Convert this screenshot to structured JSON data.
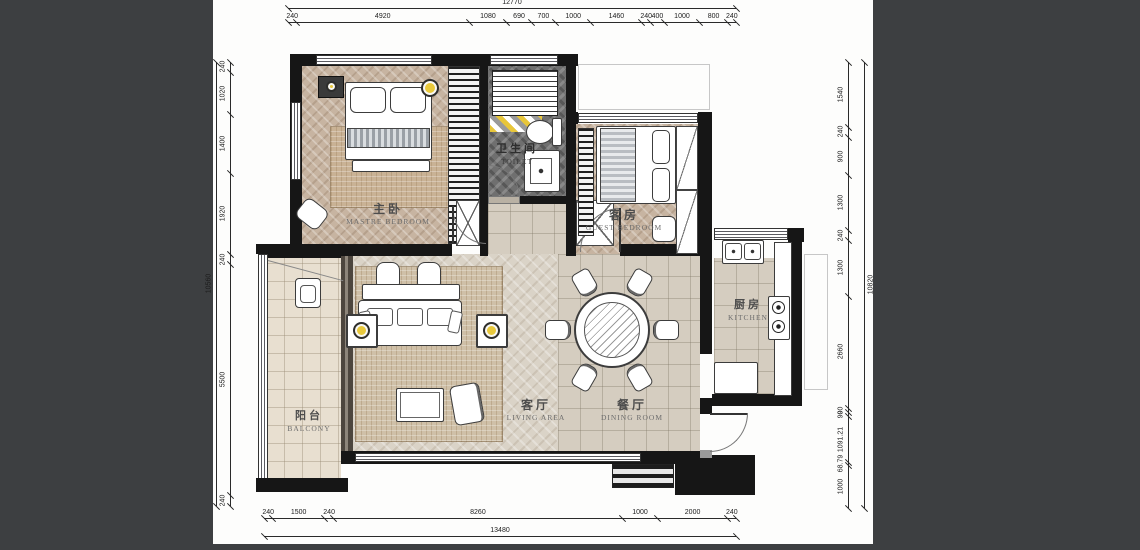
{
  "title": "apartment-floor-plan",
  "colors": {
    "background": "#3d3f41",
    "paper": "#fdfdfc",
    "wall": "#161616",
    "accent_yellow": "#e9c93c",
    "bath_tile": "#6f6f6f",
    "wood_floor": "#c7b4a1",
    "living_wood": "#dad3c7",
    "marble": "#d5cdc0",
    "rug": "#c9b295"
  },
  "dimensions": {
    "top": {
      "total": "12770",
      "segments": [
        "240",
        "4920",
        "1080",
        "690",
        "700",
        "1000",
        "1460",
        "240",
        "400",
        "1000",
        "800",
        "240"
      ]
    },
    "bottom": {
      "total": "13480",
      "segments": [
        "240",
        "1500",
        "240",
        "8260",
        "1000",
        "2000",
        "240"
      ]
    },
    "left": {
      "total": "10560",
      "segments": [
        "240",
        "1020",
        "1400",
        "1920",
        "240",
        "5500",
        "240"
      ]
    },
    "right": {
      "total": "10820",
      "segments": [
        "1540",
        "240",
        "900",
        "1300",
        "240",
        "1300",
        "2660",
        "90",
        "90",
        "1091.21",
        "68.79",
        "1000"
      ]
    }
  },
  "rooms": [
    {
      "id": "master-bedroom",
      "zh": "主卧",
      "en": "MASTRE BEDROOM"
    },
    {
      "id": "toilet",
      "zh": "卫生间",
      "en": "TOILET"
    },
    {
      "id": "guest-bedroom",
      "zh": "客房",
      "en": "GUEST BEDROOM"
    },
    {
      "id": "kitchen",
      "zh": "厨房",
      "en": "KITCHEN"
    },
    {
      "id": "living-area",
      "zh": "客厅",
      "en": "LIVING AREA"
    },
    {
      "id": "dining-room",
      "zh": "餐厅",
      "en": "DINING ROOM"
    },
    {
      "id": "balcony",
      "zh": "阳台",
      "en": "BALCONY"
    }
  ],
  "furniture": {
    "dining_seats": 6,
    "master_bed_pillows": 2,
    "guest_bed_pillows": 2,
    "living_lamps": 2,
    "kitchen_burners": 2
  }
}
